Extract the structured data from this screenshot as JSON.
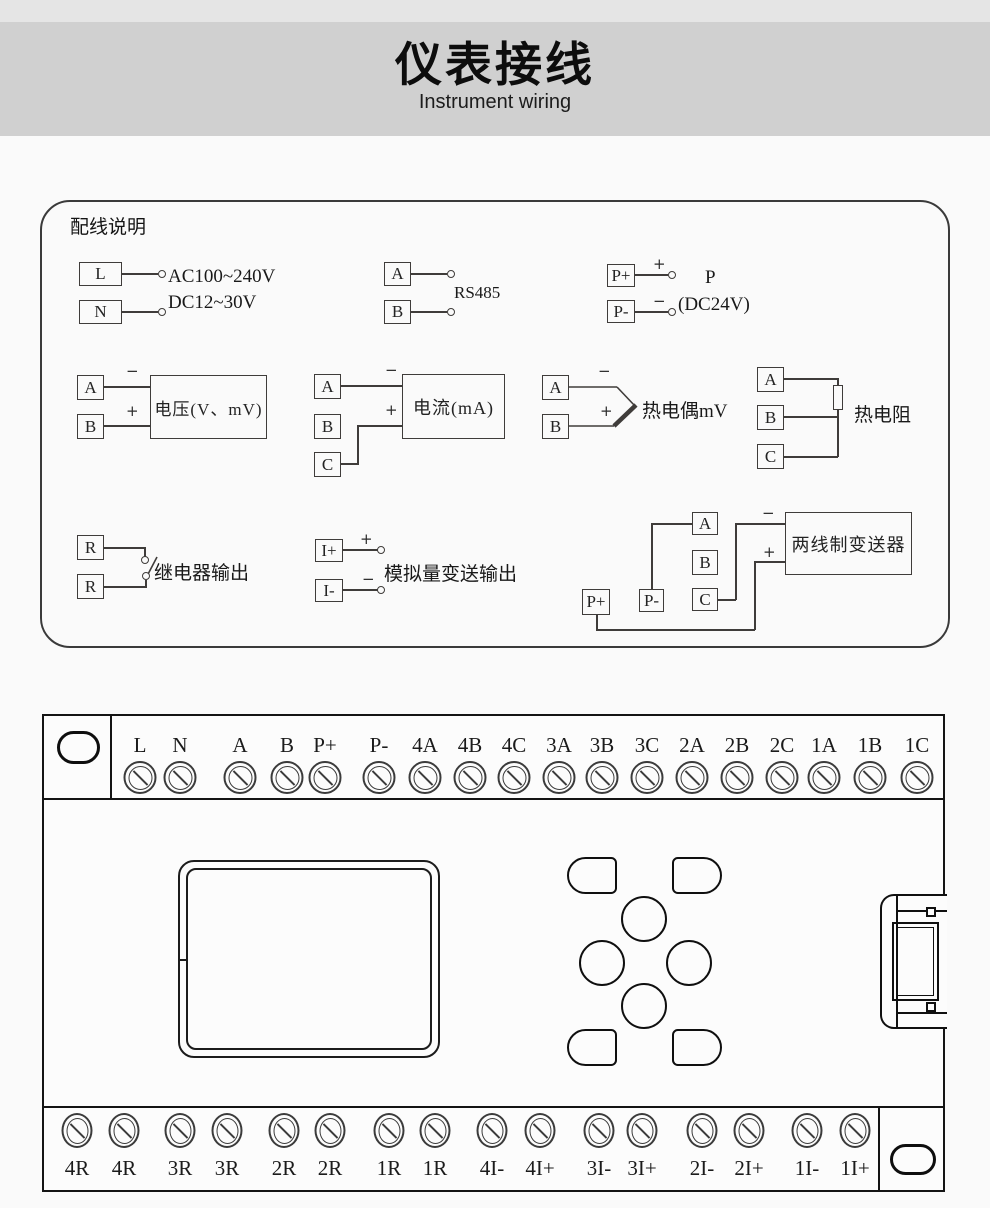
{
  "colors": {
    "header_top_strip": "#e5e5e5",
    "header_band": "#d0d0d0",
    "page_background": "#fafafa",
    "line_color": "#3f3c3a",
    "device_border": "#141414"
  },
  "header": {
    "title": "仪表接线",
    "subtitle": "Instrument wiring"
  },
  "panel": {
    "title": "配线说明",
    "power": {
      "t1": "L",
      "t2": "N",
      "line1": "AC100~240V",
      "line2": "DC12~30V"
    },
    "rs485": {
      "t1": "A",
      "t2": "B",
      "label": "RS485"
    },
    "supply": {
      "t1": "P+",
      "t2": "P-",
      "plus": "+",
      "minus": "−",
      "line1": "P",
      "line2": "(DC24V)"
    },
    "voltage": {
      "t1": "A",
      "t2": "B",
      "minus": "−",
      "plus": "+",
      "label": "电压(V、mV)"
    },
    "current": {
      "t1": "A",
      "t2": "B",
      "t3": "C",
      "minus": "−",
      "plus": "+",
      "label": "电流(mA)"
    },
    "thermocouple": {
      "t1": "A",
      "t2": "B",
      "minus": "−",
      "plus": "+",
      "label": "热电偶mV"
    },
    "rtd": {
      "t1": "A",
      "t2": "B",
      "t3": "C",
      "label": "热电阻"
    },
    "relay": {
      "t1": "R",
      "t2": "R",
      "label": "继电器输出"
    },
    "analog": {
      "t1": "I+",
      "t2": "I-",
      "plus": "+",
      "minus": "−",
      "label": "模拟量变送输出"
    },
    "transmitter": {
      "tp": "P+",
      "tm": "P-",
      "ta": "A",
      "tb": "B",
      "tc": "C",
      "minus": "−",
      "plus": "+",
      "label": "两线制变送器"
    }
  },
  "device": {
    "top_terminals": [
      "L",
      "N",
      "A",
      "B",
      "P+",
      "P-",
      "4A",
      "4B",
      "4C",
      "3A",
      "3B",
      "3C",
      "2A",
      "2B",
      "2C",
      "1A",
      "1B",
      "1C"
    ],
    "bottom_terminals": [
      "4R",
      "4R",
      "3R",
      "3R",
      "2R",
      "2R",
      "1R",
      "1R",
      "4I-",
      "4I+",
      "3I-",
      "3I+",
      "2I-",
      "2I+",
      "1I-",
      "1I+"
    ]
  }
}
